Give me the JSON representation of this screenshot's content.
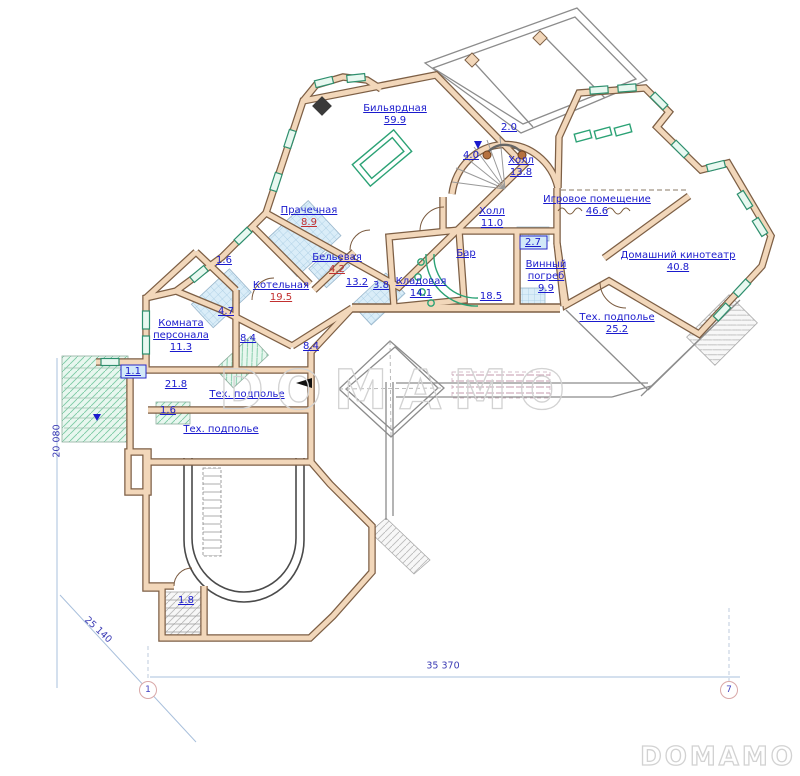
{
  "watermarks": {
    "center": "DOMAMO",
    "corner": "DOMAMO"
  },
  "dimensions": {
    "left_vertical": "20 080",
    "diagonal": "25 140",
    "bottom_horizontal": "35 370"
  },
  "axis_markers": {
    "left": "1",
    "right": "7"
  },
  "rooms": [
    {
      "name": "Бильярдная",
      "area": "59.9",
      "area_color": "blue"
    },
    {
      "name": "Холл",
      "area": "13.8",
      "area_color": "blue"
    },
    {
      "name": "Игровое помещение",
      "area": "46.6",
      "area_color": "blue"
    },
    {
      "name": "Холл",
      "area": "11.0",
      "area_color": "blue"
    },
    {
      "name": "Домашний кинотеатр",
      "area": "40.8",
      "area_color": "blue"
    },
    {
      "name": "Прачечная",
      "area": "8.9",
      "area_color": "red"
    },
    {
      "name": "Бельевая",
      "area": "4.2",
      "area_color": "red"
    },
    {
      "name": "Котельная",
      "area": "19.5",
      "area_color": "red"
    },
    {
      "name": "Кладовая",
      "area": "14.1",
      "area_color": "blue"
    },
    {
      "name": "Бар",
      "area": "",
      "area_color": "blue"
    },
    {
      "name": "Винный погреб",
      "area": "9.9",
      "area_color": "blue"
    },
    {
      "name": "Комната персонала",
      "area": "11.3",
      "area_color": "blue"
    },
    {
      "name": "Тех. подполье",
      "area": "25.2",
      "area_color": "blue"
    },
    {
      "name": "Тех. подполье",
      "area": "",
      "area_color": "blue"
    },
    {
      "name": "Тех. подполье",
      "area": "",
      "area_color": "blue"
    }
  ],
  "measurements": [
    {
      "value": "2.0",
      "color": "blue"
    },
    {
      "value": "4.0",
      "color": "blue"
    },
    {
      "value": "2.7",
      "color": "blue"
    },
    {
      "value": "13.2",
      "color": "blue"
    },
    {
      "value": "3.8",
      "color": "blue"
    },
    {
      "value": "18.5",
      "color": "blue"
    },
    {
      "value": "8.4",
      "color": "blue"
    },
    {
      "value": "8.4",
      "color": "blue"
    },
    {
      "value": "4.7",
      "color": "blue"
    },
    {
      "value": "1.6",
      "color": "red"
    },
    {
      "value": "21.8",
      "color": "blue"
    },
    {
      "value": "1.1",
      "color": "blue"
    },
    {
      "value": "1.6",
      "color": "red"
    },
    {
      "value": "1.8",
      "color": "red"
    }
  ],
  "colors": {
    "wall_fill": "#f2d7ba",
    "wall_edge": "#7d5f45",
    "label_blue": "#1a1acd",
    "label_red": "#c23030",
    "window_green": "#2ba275",
    "wet_hatch_blue": "#daedf8",
    "stair_hatch_green": "#e8f7ef",
    "dimension_line": "#a9c0dc",
    "watermark_gray": "#d2d2d2"
  }
}
